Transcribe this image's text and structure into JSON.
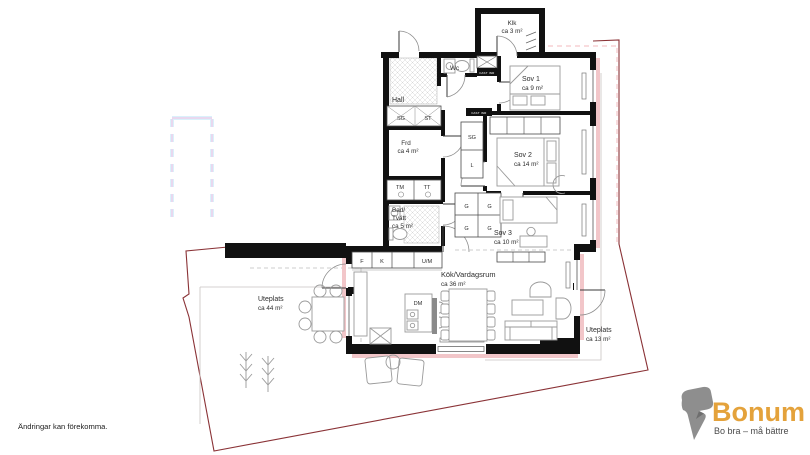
{
  "plan": {
    "disclaimer": "Ändringar kan förekomma.",
    "rooms": {
      "hall": {
        "name": "Hall"
      },
      "wc": {
        "name": "Wc"
      },
      "klk": {
        "name": "Klk",
        "area": "ca 3 m²"
      },
      "sov1": {
        "name": "Sov 1",
        "area": "ca 9 m²"
      },
      "frd": {
        "name": "Frd",
        "area": "ca 4 m²"
      },
      "sov2": {
        "name": "Sov 2",
        "area": "ca 14 m²"
      },
      "bad": {
        "name_line1": "Bad/",
        "name_line2": "Tvätt",
        "area": "ca 5 m²"
      },
      "sov3": {
        "name": "Sov 3",
        "area": "ca 10 m²"
      },
      "kok": {
        "name": "Kök/Vardagsrum",
        "area": "ca 36 m²"
      },
      "uteplats_left": {
        "name": "Uteplats",
        "area": "ca 44 m²"
      },
      "uteplats_right": {
        "name": "Uteplats",
        "area": "ca 13 m²"
      }
    },
    "fixtures": {
      "sg": "SG",
      "st": "ST",
      "l": "L",
      "tm": "TM",
      "tt": "TT",
      "g": "G",
      "f": "F",
      "k": "K",
      "um": "U/M",
      "dm": "DM",
      "shaft": "FAST INR"
    }
  },
  "logo": {
    "brand": "Bonum",
    "tagline": "Bo bra – må bättre",
    "brand_color": "#E4A23B",
    "icon_color": "#8E8E8E",
    "tagline_color": "#4A4A4A"
  },
  "colors": {
    "wall": "#111111",
    "boundary_red": "#8A3236",
    "window_pink": "#F2C6C9",
    "dashed_pink": "#F3B9BD",
    "outline_cyan": "#DAF1FB",
    "outline_pink": "#F6BFE3",
    "furniture_gray": "#9A9A9A"
  }
}
